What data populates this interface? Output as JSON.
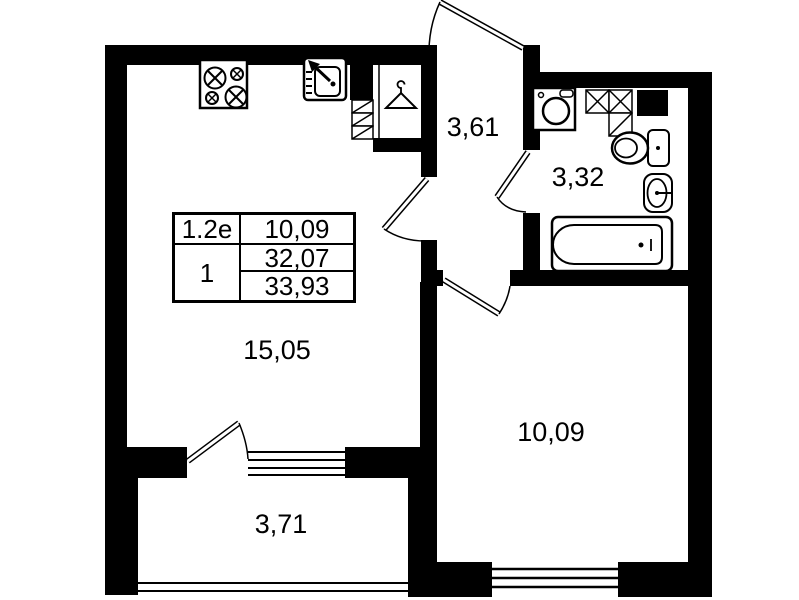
{
  "plan": {
    "rooms": [
      {
        "id": "hallway",
        "area_label": "3,61"
      },
      {
        "id": "bathroom",
        "area_label": "3,32"
      },
      {
        "id": "living-kitchen",
        "area_label": "15,05"
      },
      {
        "id": "bedroom",
        "area_label": "10,09"
      },
      {
        "id": "balcony",
        "area_label": "3,71"
      }
    ],
    "info_table": {
      "unit_type": "1.2е",
      "room_area": "10,09",
      "rooms_count": "1",
      "living_area": "32,07",
      "total_area": "33,93"
    },
    "colors": {
      "walls": "#000000",
      "background": "#ffffff"
    },
    "icons": [
      "stove-icon",
      "kitchen-sink-icon",
      "hanger-icon",
      "vent-hatch-icon",
      "washing-machine-icon",
      "toilet-icon",
      "washbasin-icon",
      "bathtub-icon"
    ]
  }
}
